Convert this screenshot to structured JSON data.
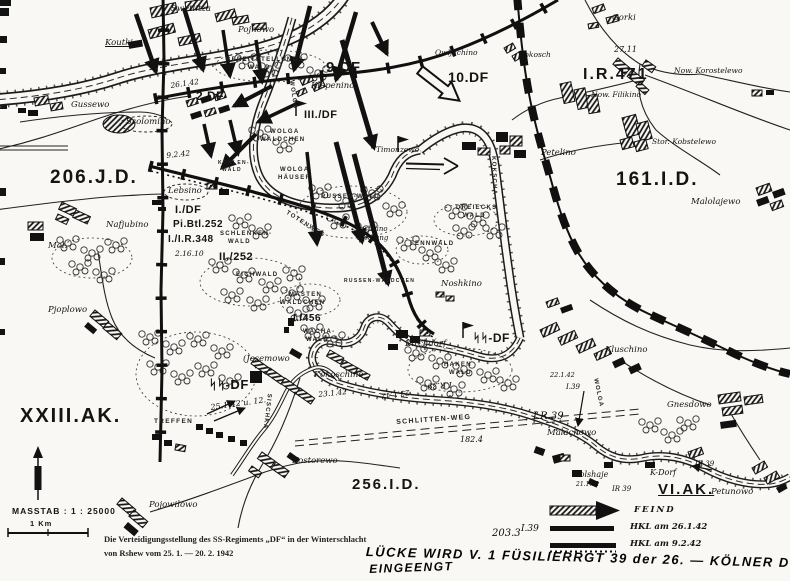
{
  "map": {
    "caption_line1": "Die Verteidigungsstellung des SS-Regiments „DF“ in der Winterschlacht",
    "caption_line2": "von Rshew vom 25. 1. — 20. 2. 1942",
    "scale_label": "MASSTAB : 1 : 25000",
    "scale_bar_label": "1 Km"
  },
  "legend": {
    "items": [
      {
        "symbol": "enemy-attack-arrow",
        "label": "FEIND"
      },
      {
        "symbol": "front-line-solid",
        "label": "HKL am 26.1.42"
      },
      {
        "symbol": "front-line-dotted",
        "label": "HKL am 9.2.42"
      }
    ]
  },
  "labels": {
    "formations": [
      {
        "t": "206.J.D.",
        "x": 50,
        "y": 168,
        "s": 19
      },
      {
        "t": "161.I.D.",
        "x": 616,
        "y": 170,
        "s": 19
      },
      {
        "t": "I.R.471",
        "x": 583,
        "y": 67,
        "s": 16
      },
      {
        "t": "XXIII.AK.",
        "x": 20,
        "y": 406,
        "s": 20
      },
      {
        "t": "256.I.D.",
        "x": 352,
        "y": 477,
        "s": 15
      },
      {
        "t": "VI.AK.",
        "x": 658,
        "y": 482,
        "s": 15,
        "cls": "ul"
      }
    ],
    "own_units": [
      {
        "t": "9.DF",
        "x": 326,
        "y": 60,
        "s": 15
      },
      {
        "t": "2.DF",
        "x": 196,
        "y": 90,
        "s": 12
      },
      {
        "t": "III./DF",
        "x": 304,
        "y": 110,
        "s": 11
      },
      {
        "t": "10.DF",
        "x": 448,
        "y": 70,
        "s": 14
      },
      {
        "t": "I./DF",
        "x": 175,
        "y": 205,
        "s": 11
      },
      {
        "t": "Pi.Btl.252",
        "x": 173,
        "y": 220,
        "s": 10
      },
      {
        "t": "I./I.R.348",
        "x": 168,
        "y": 235,
        "s": 10
      },
      {
        "t": "II./252",
        "x": 219,
        "y": 252,
        "s": 11
      },
      {
        "t": "I./456",
        "x": 293,
        "y": 314,
        "s": 10
      },
      {
        "t": "ᛋᛋ-DF",
        "x": 209,
        "y": 378,
        "s": 13
      },
      {
        "t": "ᛋᛋ-DF",
        "x": 473,
        "y": 332,
        "s": 12
      }
    ],
    "places": [
      {
        "t": "Swetlitza",
        "x": 171,
        "y": 5
      },
      {
        "t": "Pojnowo",
        "x": 238,
        "y": 26
      },
      {
        "t": "Koutki",
        "x": 105,
        "y": 39,
        "cls": "ul"
      },
      {
        "t": "Gorki",
        "x": 612,
        "y": 14
      },
      {
        "t": "Now. Korostelewo",
        "x": 674,
        "y": 67,
        "s": 7.5
      },
      {
        "t": "Now. Filikino",
        "x": 591,
        "y": 91,
        "s": 7.5
      },
      {
        "t": "Stor. Kobstelewo",
        "x": 652,
        "y": 138,
        "s": 7.5
      },
      {
        "t": "Kokosch",
        "x": 519,
        "y": 51,
        "s": 7.5
      },
      {
        "t": "Klepenino",
        "x": 311,
        "y": 82
      },
      {
        "t": "Owljachino",
        "x": 435,
        "y": 49,
        "s": 7.5
      },
      {
        "t": "Petelino",
        "x": 541,
        "y": 149
      },
      {
        "t": "Malolajewo",
        "x": 691,
        "y": 198
      },
      {
        "t": "Gussewo",
        "x": 71,
        "y": 101
      },
      {
        "t": "Ssolomino",
        "x": 126,
        "y": 118
      },
      {
        "t": "Lebsino",
        "x": 168,
        "y": 187
      },
      {
        "t": "Nafjubino",
        "x": 106,
        "y": 221
      },
      {
        "t": "Mol.-",
        "x": 48,
        "y": 242
      },
      {
        "t": "Pjoplowo",
        "x": 48,
        "y": 306
      },
      {
        "t": "(Jesemowo",
        "x": 243,
        "y": 355
      },
      {
        "t": "Kokoschino",
        "x": 314,
        "y": 371
      },
      {
        "t": "Kirchdorf",
        "x": 405,
        "y": 340
      },
      {
        "t": "Noshkino",
        "x": 441,
        "y": 280
      },
      {
        "t": "Noshkino",
        "x": 354,
        "y": 226,
        "s": 7
      },
      {
        "t": "Siedlung",
        "x": 357,
        "y": 235,
        "s": 7
      },
      {
        "t": "Timonzewo",
        "x": 376,
        "y": 146,
        "s": 7.5
      },
      {
        "t": "Kluschino",
        "x": 605,
        "y": 346
      },
      {
        "t": "Gnesdowo",
        "x": 667,
        "y": 401
      },
      {
        "t": "Malachowo",
        "x": 547,
        "y": 429
      },
      {
        "t": "Wolshaje",
        "x": 572,
        "y": 471,
        "s": 8
      },
      {
        "t": "Petunowo",
        "x": 711,
        "y": 488
      },
      {
        "t": "Kostorewo",
        "x": 292,
        "y": 457
      },
      {
        "t": "Pojowilowo",
        "x": 149,
        "y": 501
      }
    ],
    "terrain": [
      {
        "t": "BEREITSTELLUNGS-",
        "x": 226,
        "y": 57
      },
      {
        "t": "WALD",
        "x": 248,
        "y": 65
      },
      {
        "t": "WOLGA",
        "x": 270,
        "y": 129
      },
      {
        "t": "WÄLDCHEN",
        "x": 260,
        "y": 137
      },
      {
        "t": "WOLGA",
        "x": 280,
        "y": 167
      },
      {
        "t": "HÄUSER",
        "x": 278,
        "y": 175
      },
      {
        "t": "RUSSEN-WALD",
        "x": 321,
        "y": 194
      },
      {
        "t": "TOTENWEG",
        "x": 288,
        "y": 210,
        "r": 32
      },
      {
        "t": "SCHLENKEN-",
        "x": 220,
        "y": 231
      },
      {
        "t": "WALD",
        "x": 228,
        "y": 239
      },
      {
        "t": "EICHWALD",
        "x": 236,
        "y": 272
      },
      {
        "t": "MASTEN",
        "x": 289,
        "y": 292
      },
      {
        "t": "WÄLDCHEN",
        "x": 280,
        "y": 300
      },
      {
        "t": "WACHA-",
        "x": 303,
        "y": 329
      },
      {
        "t": "WALD",
        "x": 306,
        "y": 337
      },
      {
        "t": "FENNWALD",
        "x": 410,
        "y": 241
      },
      {
        "t": "DREIECKS",
        "x": 456,
        "y": 205
      },
      {
        "t": "WALD",
        "x": 463,
        "y": 213
      },
      {
        "t": "HAKEN",
        "x": 444,
        "y": 362
      },
      {
        "t": "WALD",
        "x": 449,
        "y": 370
      },
      {
        "t": "RUSSEN-WÄLDCHEN",
        "x": 344,
        "y": 279,
        "s": 5
      },
      {
        "t": "KOHLEN-",
        "x": 218,
        "y": 161,
        "s": 5
      },
      {
        "t": "WALD",
        "x": 222,
        "y": 168,
        "s": 5
      },
      {
        "t": "SCHLITTEN-WEG",
        "x": 396,
        "y": 419,
        "s": 7,
        "r": -4
      },
      {
        "t": "TREFFEN",
        "x": 154,
        "y": 419,
        "s": 6.5
      },
      {
        "t": "KOKSCHA",
        "x": 496,
        "y": 156,
        "r": 88
      },
      {
        "t": "WOLGA",
        "x": 598,
        "y": 378,
        "r": 78
      },
      {
        "t": "SISCHKA",
        "x": 272,
        "y": 394,
        "r": 97
      },
      {
        "t": "WOLGA",
        "x": 294,
        "y": 80,
        "r": 82
      }
    ],
    "annotations": [
      {
        "t": "26.1.42",
        "x": 170,
        "y": 82,
        "r": -8
      },
      {
        "t": "9.2.42",
        "x": 166,
        "y": 152,
        "r": -6
      },
      {
        "t": "2.16.10",
        "x": 175,
        "y": 250
      },
      {
        "t": "27.11",
        "x": 614,
        "y": 46,
        "s": 8
      },
      {
        "t": "25.1.42 u. 12.",
        "x": 210,
        "y": 404,
        "r": -8,
        "s": 8
      },
      {
        "t": "23.1.42",
        "x": 318,
        "y": 391,
        "r": -6
      },
      {
        "t": "23.1.42",
        "x": 410,
        "y": 396,
        "r": 172
      },
      {
        "t": "I.R.39",
        "x": 452,
        "y": 388,
        "r": 176,
        "s": 8
      },
      {
        "t": "22.1.42",
        "x": 550,
        "y": 372,
        "s": 6.5
      },
      {
        "t": "I.39",
        "x": 566,
        "y": 384,
        "s": 7
      },
      {
        "t": "I.R.39",
        "x": 533,
        "y": 412,
        "s": 10
      },
      {
        "t": "182.4",
        "x": 460,
        "y": 436,
        "s": 8
      },
      {
        "t": "21.1.42",
        "x": 576,
        "y": 482,
        "s": 6
      },
      {
        "t": "K-Dorf",
        "x": 650,
        "y": 469,
        "s": 8
      },
      {
        "t": "IR 39",
        "x": 695,
        "y": 461,
        "s": 7
      },
      {
        "t": "IR 39",
        "x": 612,
        "y": 486,
        "s": 7
      },
      {
        "t": "203.3",
        "x": 492,
        "y": 529,
        "s": 10
      },
      {
        "t": "I.39",
        "x": 521,
        "y": 525,
        "s": 9
      }
    ],
    "hand_notes": [
      {
        "t": "LÜCKE WIRD V. 1 FÜSILIERRGT 39 der 26. — KÖLNER DOM",
        "x": 366,
        "y": 545,
        "s": 13,
        "r": 1.5
      },
      {
        "t": "EINGEENGT",
        "x": 369,
        "y": 563,
        "s": 12,
        "r": -2
      }
    ]
  }
}
